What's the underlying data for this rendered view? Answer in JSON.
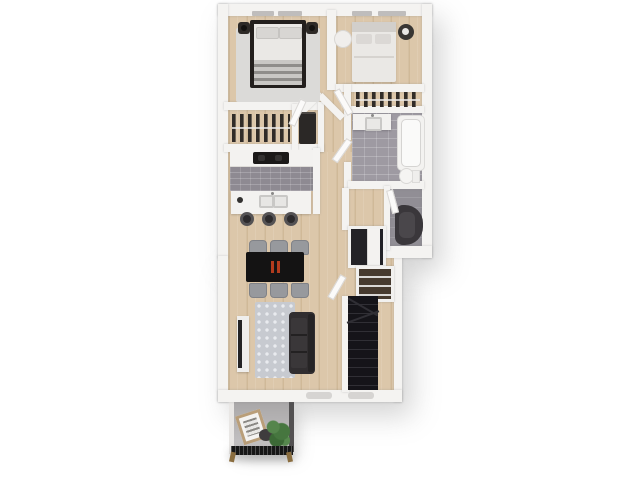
{
  "scene": {
    "type": "3d-floor-plan-render",
    "description": "Top-down 3D rendering of a two-bedroom apartment floor plan with kitchen, dining, living room, bathroom, staircase and balcony on a white background",
    "visible_text": "",
    "background_color": "#ffffff"
  },
  "colors": {
    "background": "#ffffff",
    "wall": "#f4f3f1",
    "wood_floor": "#dcc7aa",
    "wood_plank": "#d0b998",
    "tile_bathroom": "#9e9aa2",
    "tile_kitchen": "#8e8a92",
    "tile_entry": "#918e95",
    "balcony_floor": "#b3b1b2",
    "rug_bedroom": "#dbdad8",
    "rug_living": "#c7cad0",
    "rug_living_dot": "#e9ebef",
    "furniture_dark": "#262220",
    "bedding_white": "#eae8e5",
    "sofa": "#312e30",
    "stairs": "#151419",
    "stair_tread": "#302f35",
    "table_black": "#141313",
    "chair_gray": "#97999d",
    "accent_red": "#b23b1d",
    "plant_green": "#4c7a45",
    "railing_black": "#161616",
    "brass": "#8a6d3f",
    "window_gray": "#bfbdbc"
  },
  "rooms": [
    {
      "name": "bedroom-1",
      "furniture": [
        "dark-frame-double-bed",
        "two-pillows",
        "striped-blanket",
        "nightstand-left-with-lamp",
        "nightstand-right-with-lamp",
        "area-rug",
        "window"
      ]
    },
    {
      "name": "bedroom-2",
      "furniture": [
        "light-double-bed",
        "round-ottoman",
        "round-nightstand",
        "window"
      ]
    },
    {
      "name": "closet-bedroom-1",
      "furniture": [
        "hanging-clothes-rail",
        "dark-dresser"
      ]
    },
    {
      "name": "closet-bedroom-2",
      "furniture": [
        "hanging-clothes-rail"
      ]
    },
    {
      "name": "bathroom",
      "furniture": [
        "vanity-with-sink",
        "bathtub",
        "toilet",
        "tiled-floor"
      ]
    },
    {
      "name": "entry-laundry-room",
      "furniture": [
        "dark-armchair",
        "door"
      ]
    },
    {
      "name": "kitchen",
      "furniture": [
        "counter",
        "cooktop",
        "island-with-double-sink",
        "bar-stool",
        "bar-stool",
        "bar-stool"
      ]
    },
    {
      "name": "dining-area",
      "furniture": [
        "black-dining-table",
        "red-centerpiece",
        "six-gray-chairs"
      ]
    },
    {
      "name": "living-room",
      "furniture": [
        "dark-sofa",
        "patterned-rug",
        "tv-console"
      ]
    },
    {
      "name": "stair-hall",
      "furniture": [
        "dark-staircase",
        "storage-closet",
        "shoe-shelf",
        "door"
      ]
    },
    {
      "name": "balcony",
      "furniture": [
        "leaning-picture-frame",
        "potted-plant",
        "stone",
        "black-railing-with-brass-feet"
      ]
    }
  ]
}
